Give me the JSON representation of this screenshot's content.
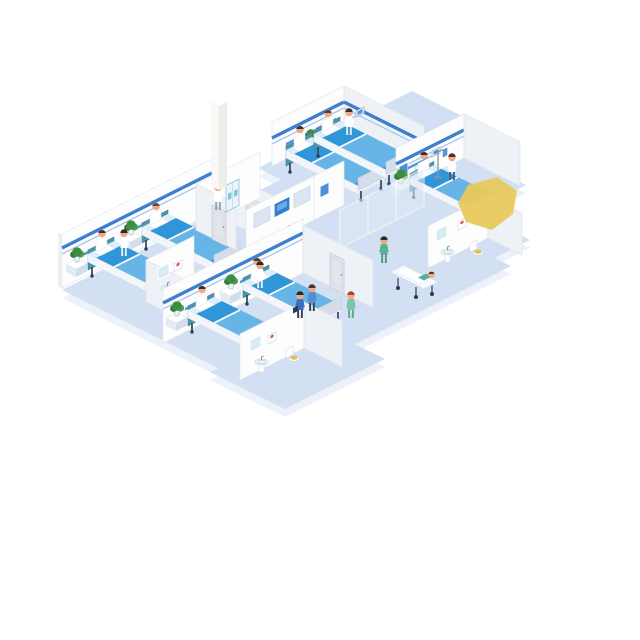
{
  "scene": {
    "title": "Isometric hospital ward floor illustration",
    "background": "#ffffff",
    "desk_sign": "护士站",
    "palette": {
      "floor": "#d3dff2",
      "floor_edge": "#edf1f9",
      "wall": "#fdfdfe",
      "wall_shaded": "#eef1f6",
      "rail_blue": "#3f7fd0",
      "bed_mattress": "#2f96d8",
      "bed_blanket": "#66b5e6",
      "headboard_teal": "#4d94a9",
      "desk_blue": "#2a5ca8",
      "screen_blue": "#2f7fd0",
      "plant_green": "#3e8e41",
      "scrubs_green": "#5cb08f",
      "scrubs_blue": "#3f6fb8",
      "highlight_yellow": "#e8c95c",
      "toilet_seat": "#e6bd55"
    },
    "rooms": [
      {
        "id": "ward-top",
        "name": "Two-bed ward (top)",
        "beds": 2,
        "patients": 2,
        "staff": 1,
        "features": [
          "headwall panels",
          "bedside plant",
          "wall monitor",
          "blue handrail"
        ]
      },
      {
        "id": "ward-left",
        "name": "Two-bed ward (left)",
        "beds": 2,
        "patients": 2,
        "staff": 1,
        "features": [
          "headwall panels",
          "bedside plants",
          "blue handrail"
        ]
      },
      {
        "id": "ward-bottom",
        "name": "Two-bed ward (bottom)",
        "beds": 2,
        "patients": 2,
        "staff": 1,
        "features": [
          "headwall panels",
          "bedside plants",
          "blue handrail"
        ]
      },
      {
        "id": "ward-right",
        "name": "Single-bed ward (right wing)",
        "beds": 1,
        "patients": 1,
        "staff": 1,
        "features": [
          "IV stand",
          "bedside plant",
          "wall monitor",
          "wall poster"
        ]
      },
      {
        "id": "bathroom-right",
        "name": "Bathroom (right wing)",
        "features": [
          "sink",
          "mirror",
          "toilet",
          "first-aid picture"
        ]
      },
      {
        "id": "bathroom-bottom",
        "name": "Bathroom (bottom)",
        "features": [
          "sink",
          "mirror",
          "toilet",
          "first-aid picture"
        ]
      },
      {
        "id": "washroom-left",
        "name": "Washroom (center-left)",
        "features": [
          "sink",
          "mirror",
          "toilet",
          "first-aid picture"
        ]
      },
      {
        "id": "supply-room",
        "name": "Supply room",
        "staff": 1,
        "features": [
          "medicine cabinet",
          "door",
          "tall column"
        ]
      },
      {
        "id": "reception",
        "name": "Nurse station / reception",
        "staff": 1,
        "features": [
          "monitor wall with 3 panels",
          "U-shaped blue desk",
          "desk sign",
          "counter plant",
          "counter monitor"
        ]
      },
      {
        "id": "kiosk-area",
        "name": "Self-service kiosk area",
        "kiosks": 2,
        "visitors": 2,
        "features": [
          "glass partition"
        ]
      },
      {
        "id": "corridor",
        "name": "Corridor",
        "people": [
          "two staff walking",
          "nurse in green walking",
          "nurse pushing stretcher with patient"
        ],
        "features": [
          "doors",
          "wall posters",
          "yellow highlight marker"
        ]
      }
    ],
    "people_totals": {
      "patients": 8,
      "staff_and_visitors": 12
    }
  }
}
